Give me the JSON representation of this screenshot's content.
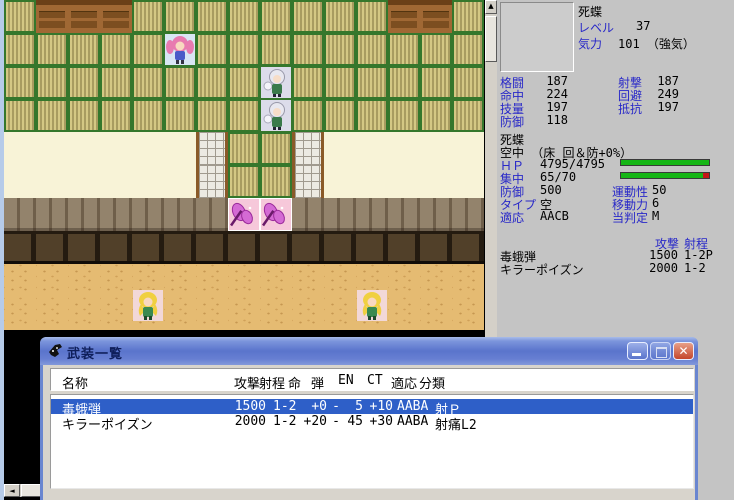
{
  "colors": {
    "label_blue": "#2828c8",
    "selection_blue": "#2e5fc8",
    "hp_bar_green": "#16b616",
    "en_bar_red": "#c41616",
    "titlebar_blue": "#5a74cc",
    "close_red": "#c4462c",
    "panel_gray": "#c4c4c4"
  },
  "map": {
    "legend": {
      "T": "tatami",
      "C": "chest",
      "S": "shoji",
      "L": "lattice",
      "P": "plank-wall",
      "B": "wall-base",
      "D": "sand",
      "F": "butterfly-pad"
    },
    "rows": [
      "TCCCTTTTTTTTCCT",
      "TTTTTTTTTTTTTTT",
      "TTTTTTTTTTTTTTT",
      "TTTTTTTTTTTTTTT",
      "SSSSSSLTTLSSSSS",
      "SSSSSSLTTLSSSSS",
      "PPPPPPPFFPPPPPP",
      "BBBBBBBBBBBBBBB",
      "DDDDDDDDDDDDDDD",
      "DDDDDDDDDDDDDDD"
    ],
    "sprites": [
      {
        "name": "unit-sprite-pink-girl",
        "type": "girl",
        "col": 5,
        "row": 1,
        "bg": "#d8e6f4",
        "dy": 0
      },
      {
        "name": "unit-sprite-ghost-1",
        "type": "ghost",
        "col": 8,
        "row": 2,
        "bg": "#dcdcea",
        "dy": 0
      },
      {
        "name": "unit-sprite-ghost-2",
        "type": "ghost",
        "col": 8,
        "row": 3,
        "bg": "#dcdcea",
        "dy": 0
      },
      {
        "name": "unit-sprite-butterfly-1",
        "type": "butterfly",
        "col": 7,
        "row": 6,
        "bg": "",
        "dy": 0
      },
      {
        "name": "unit-sprite-butterfly-2",
        "type": "butterfly",
        "col": 8,
        "row": 6,
        "bg": "",
        "dy": 0
      },
      {
        "name": "unit-sprite-fairy-1",
        "type": "fairy",
        "col": 4,
        "row": 9,
        "bg": "#f2d8d8",
        "dy": -8
      },
      {
        "name": "unit-sprite-fairy-2",
        "type": "fairy",
        "col": 11,
        "row": 9,
        "bg": "#f2d8d8",
        "dy": -8
      }
    ],
    "scrollbar_up_glyph": "▲",
    "scrollbar_left_glyph": "◄"
  },
  "status_panel": {
    "unit_name": "死蝶",
    "level_label": "レベル",
    "level_value": "37",
    "morale_label": "気力",
    "morale_value": "101 （強気）",
    "stats_left": [
      {
        "label": "格闘",
        "value": "187"
      },
      {
        "label": "命中",
        "value": "224"
      },
      {
        "label": "技量",
        "value": "197"
      },
      {
        "label": "防御",
        "value": "118"
      }
    ],
    "stats_right": [
      {
        "label": "射撃",
        "value": "187"
      },
      {
        "label": "回避",
        "value": "249"
      },
      {
        "label": "抵抗",
        "value": "197"
      }
    ],
    "detail_name": "死蝶",
    "terrain_line": "空中 （床 回＆防+0%）",
    "hp_label": "ＨＰ",
    "hp_value": "4795/4795",
    "hp_pct": 100,
    "en_label": "集中",
    "en_value": "65/70",
    "en_pct": 93,
    "detail_rows": [
      {
        "l1": "防御",
        "v1": "500",
        "l2": "運動性",
        "v2": "50"
      },
      {
        "l1": "タイプ",
        "v1": "空",
        "l2": "移動力",
        "v2": "6"
      },
      {
        "l1": "適応",
        "v1": "AACB",
        "l2": "当判定",
        "v2": "M"
      }
    ],
    "weapon_header_atk": "攻撃",
    "weapon_header_range": "射程",
    "weapons": [
      {
        "name": "毒蛾弾",
        "atk": "1500",
        "range": "1-2P"
      },
      {
        "name": "キラーポイズン",
        "atk": "2000",
        "range": "1-2"
      }
    ]
  },
  "weapon_window": {
    "title": "武装一覧",
    "close_glyph": "✕",
    "headers": [
      "名称",
      "攻撃",
      "射程",
      "命",
      "弾",
      "EN",
      "CT",
      "適応",
      "分類"
    ],
    "rows": [
      {
        "name": "毒蛾弾",
        "atk": "1500",
        "range": "1-2",
        "hit": "+0",
        "ammo": "-",
        "en": "5",
        "ct": "+10",
        "adapt": "AABA",
        "class": "射Ｐ",
        "selected": true
      },
      {
        "name": "キラーポイズン",
        "atk": "2000",
        "range": "1-2",
        "hit": "+20",
        "ammo": "-",
        "en": "45",
        "ct": "+30",
        "adapt": "AABA",
        "class": "射痛L2",
        "selected": false
      }
    ]
  }
}
